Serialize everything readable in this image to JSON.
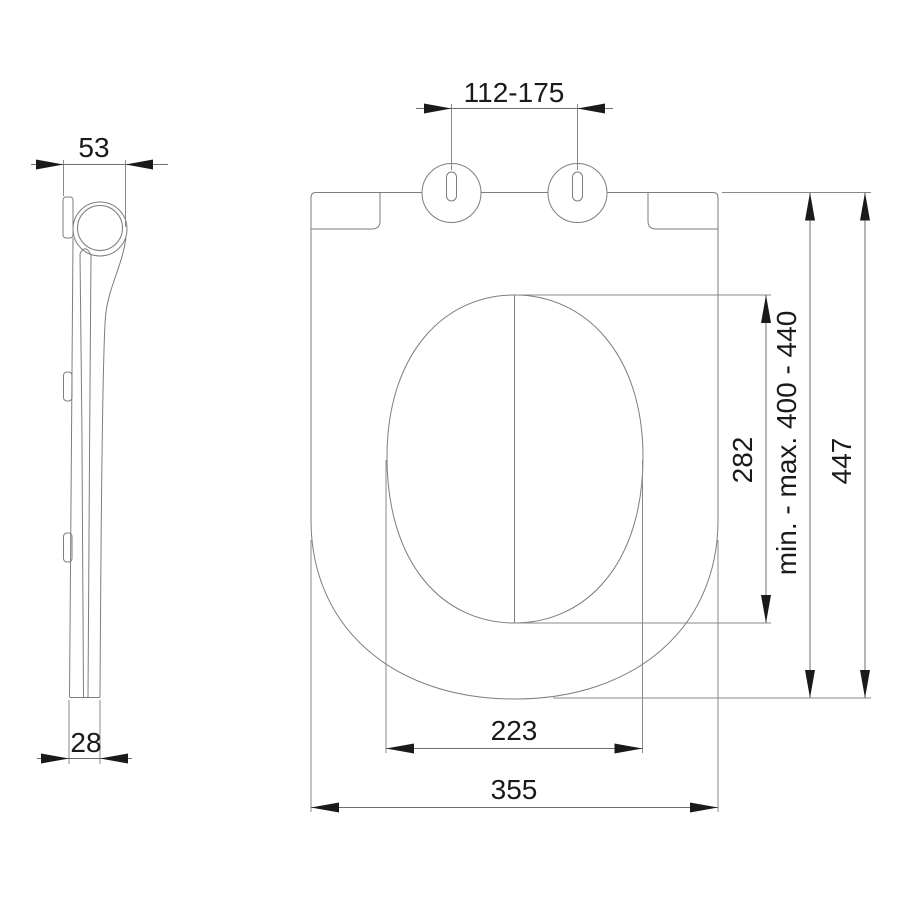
{
  "drawing": {
    "type": "technical-dimension-drawing",
    "views": {
      "side_view": "seat profile (left)",
      "plan_view": "seat top view (right)"
    },
    "colors": {
      "background": "#ffffff",
      "outline_line": "#7e7e7e",
      "dimension_line": "#6f6f6f",
      "text_and_arrows": "#1a1a1a"
    }
  },
  "dims": {
    "hinge_spacing": "112-175",
    "side_depth": "53",
    "side_bottom_thickness": "28",
    "opening_width": "223",
    "overall_width": "355",
    "opening_length": "282",
    "install_range": "min. - max. 400 - 440",
    "overall_length": "447"
  }
}
